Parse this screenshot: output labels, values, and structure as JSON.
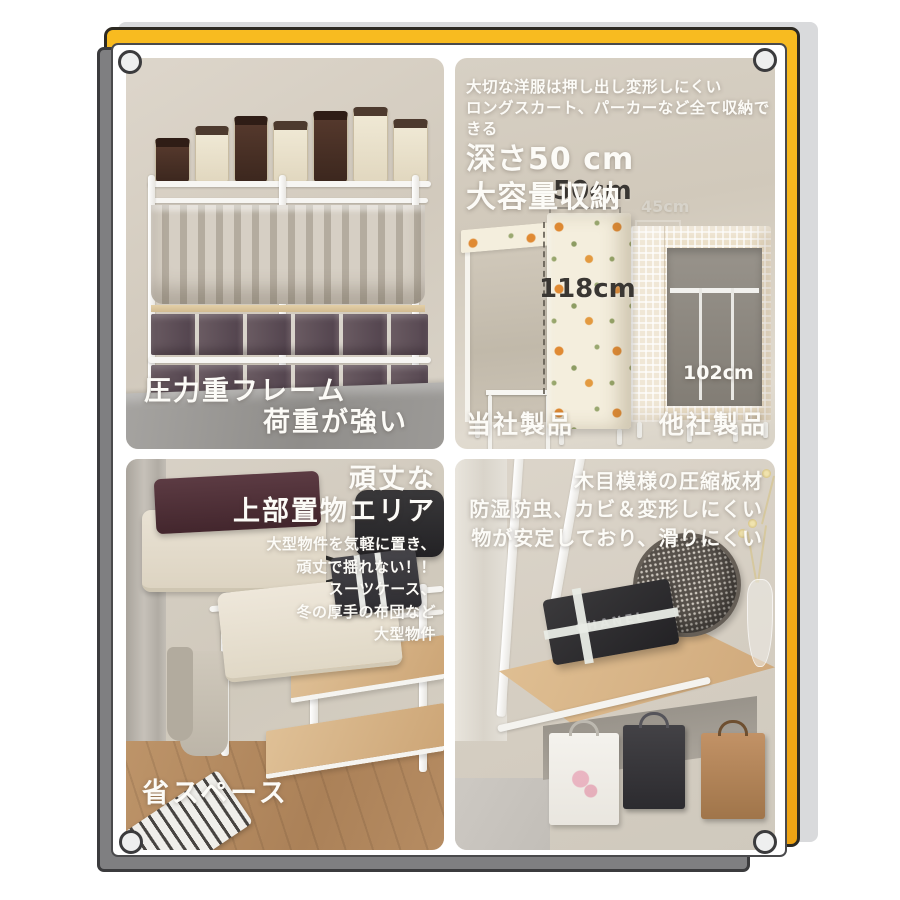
{
  "palette": {
    "accent_yellow": "#f3ab17",
    "card_gray": "#7f7f81",
    "card_outline": "#3b3b3d",
    "photo_beige": "#d5cec2",
    "text_white": "#fcfbf7",
    "text_dark": "#3a3733"
  },
  "top_left": {
    "caption_line1": "圧力重フレーム",
    "caption_line2": "荷重が強い"
  },
  "top_right": {
    "small_line1": "大切な洋服は押し出し変形しにくい",
    "small_line2": "ロングスカート、パーカーなど全て収納できる",
    "big_line1": "深さ50 cm",
    "big_line2": "大容量収納",
    "comparison": {
      "ours": {
        "label": "当社製品",
        "depth": "50cm",
        "height": "118cm"
      },
      "theirs": {
        "label": "他社製品",
        "depth": "45cm",
        "height": "102cm"
      }
    }
  },
  "bottom_left": {
    "title_line1": "頑丈な",
    "title_line2": "上部置物エリア",
    "desc_lines": [
      "大型物件を気軽に置き、",
      "頑丈で揺れない！！",
      "スーツケース、",
      "冬の厚手の布団など",
      "大型物件"
    ],
    "space_label": "省スペース"
  },
  "bottom_right": {
    "line1": "木目模様の圧縮板材",
    "line2": "防湿防虫、カビ＆変形しにくい",
    "line3": "物が安定しており、滑りにくい",
    "box_brand": "CHANEL"
  }
}
